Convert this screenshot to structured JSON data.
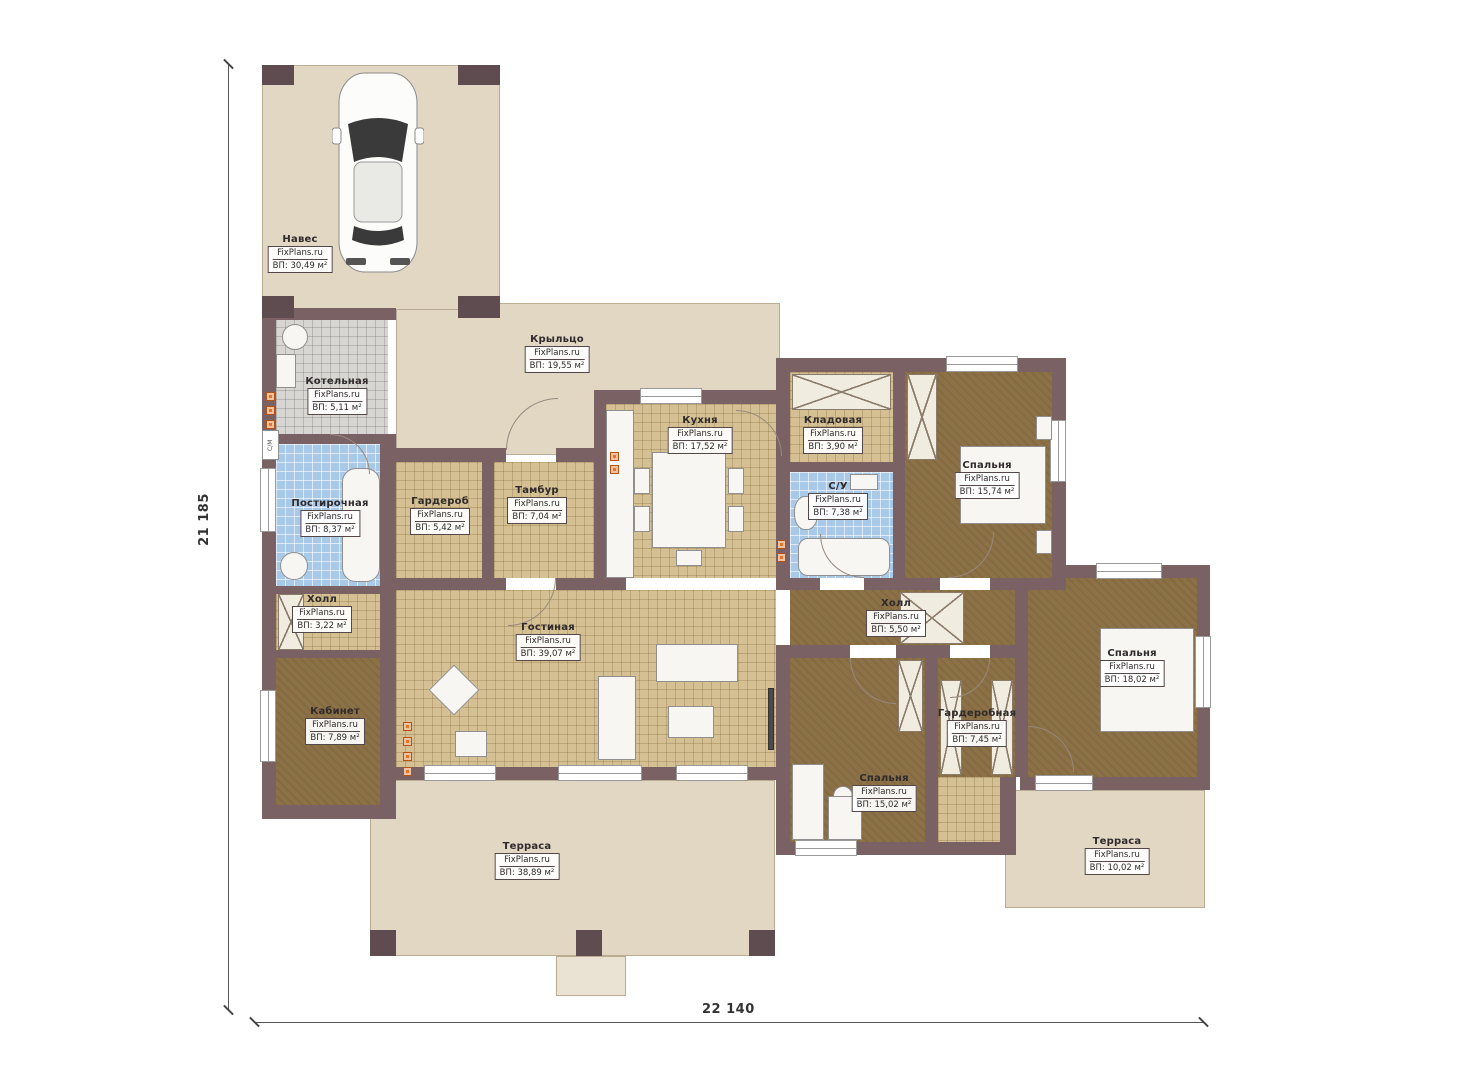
{
  "plan": {
    "watermark": "FixPlans.ru",
    "dimensions": {
      "left": "21 185",
      "bottom": "22 140"
    },
    "rooms": [
      {
        "name": "Навес",
        "source": "FixPlans.ru",
        "area": "ВП: 30,49 м²"
      },
      {
        "name": "Котельная",
        "source": "FixPlans.ru",
        "area": "ВП: 5,11 м²"
      },
      {
        "name": "Крыльцо",
        "source": "FixPlans.ru",
        "area": "ВП: 19,55 м²"
      },
      {
        "name": "Кухня",
        "source": "FixPlans.ru",
        "area": "ВП: 17,52 м²"
      },
      {
        "name": "Кладовая",
        "source": "FixPlans.ru",
        "area": "ВП: 3,90 м²"
      },
      {
        "name": "Постирочная",
        "source": "FixPlans.ru",
        "area": "ВП: 8,37 м²"
      },
      {
        "name": "Гардероб",
        "source": "FixPlans.ru",
        "area": "ВП: 5,42 м²"
      },
      {
        "name": "Тамбур",
        "source": "FixPlans.ru",
        "area": "ВП: 7,04 м²"
      },
      {
        "name": "С/У",
        "source": "FixPlans.ru",
        "area": "ВП: 7,38 м²"
      },
      {
        "name": "Спальня",
        "source": "FixPlans.ru",
        "area": "ВП: 15,74 м²"
      },
      {
        "name": "Холл",
        "source": "FixPlans.ru",
        "area": "ВП: 3,22 м²"
      },
      {
        "name": "Холл",
        "source": "FixPlans.ru",
        "area": "ВП: 5,50 м²"
      },
      {
        "name": "Гостиная",
        "source": "FixPlans.ru",
        "area": "ВП: 39,07 м²"
      },
      {
        "name": "Спальня",
        "source": "FixPlans.ru",
        "area": "ВП: 18,02 м²"
      },
      {
        "name": "Кабинет",
        "source": "FixPlans.ru",
        "area": "ВП: 7,89 м²"
      },
      {
        "name": "Гардеробная",
        "source": "FixPlans.ru",
        "area": "ВП: 7,45 м²"
      },
      {
        "name": "Спальня",
        "source": "FixPlans.ru",
        "area": "ВП: 15,02 м²"
      },
      {
        "name": "Терраса",
        "source": "FixPlans.ru",
        "area": "ВП: 38,89 м²"
      },
      {
        "name": "Терраса",
        "source": "FixPlans.ru",
        "area": "ВП: 10,02 м²"
      }
    ],
    "annotations": {
      "washer": "С/М"
    },
    "colors": {
      "wall": "#7a6264",
      "outdoor": "#e1d7c3",
      "tile": "#d5c093",
      "carpet": "#8c7146",
      "wet": "#a9c9e9",
      "boiler_tile": "#d8d6d3",
      "accent_dot": "#e0762e"
    }
  }
}
